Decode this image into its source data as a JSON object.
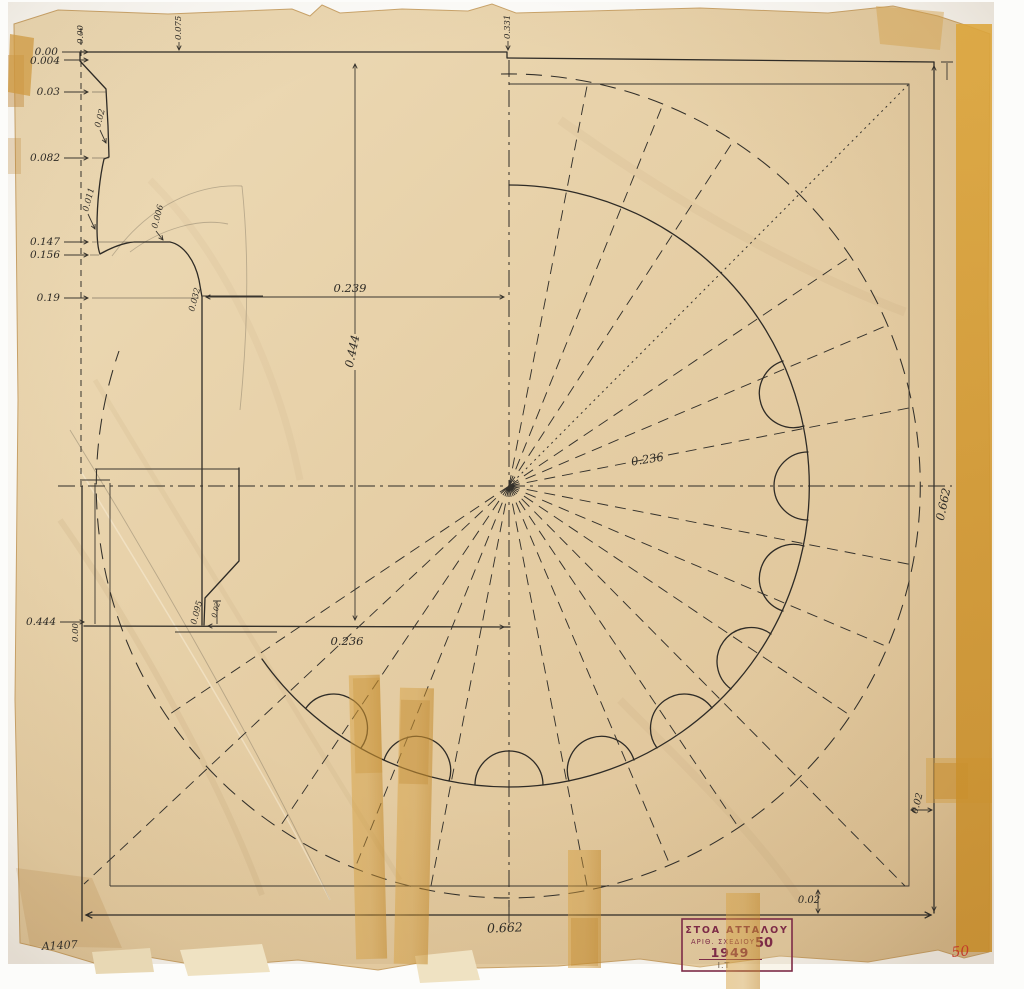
{
  "profile": {
    "scale": [
      "0.00",
      "0.004",
      "0.03",
      "0.082",
      "0.147",
      "0.156",
      "0.19",
      "0.444"
    ],
    "origin_top": "0.00",
    "origin_bottom": "0.00",
    "top_offset_left": "0.075",
    "top_offset_center": "0.331",
    "dim_step": "0.02",
    "dim_cavetto": "0.011",
    "dim_ovolo": "0.006",
    "dim_neck": "0.032",
    "dim_base": "0.095",
    "dim_fillet": "0.02",
    "width_top": "0.239",
    "height_total": "0.444",
    "width_bottom": "0.236"
  },
  "plan": {
    "flute_radius": "0.236",
    "square_width": "0.662",
    "square_height": "0.662",
    "edge_offset_bottom": "0.02",
    "edge_offset_right": "0.02"
  },
  "title_block": {
    "title": "ΣΤΟΑ ΑΤΤΑΛΟΥ",
    "drawing_no_label": "ΑΡΙΘ. ΣΧΕΔΙΟΥ",
    "drawing_no": "50",
    "year": "1949",
    "initials": "Ι.Τ"
  },
  "margin_notes": {
    "catalog_no": "A1407",
    "sheet_no": "50"
  }
}
